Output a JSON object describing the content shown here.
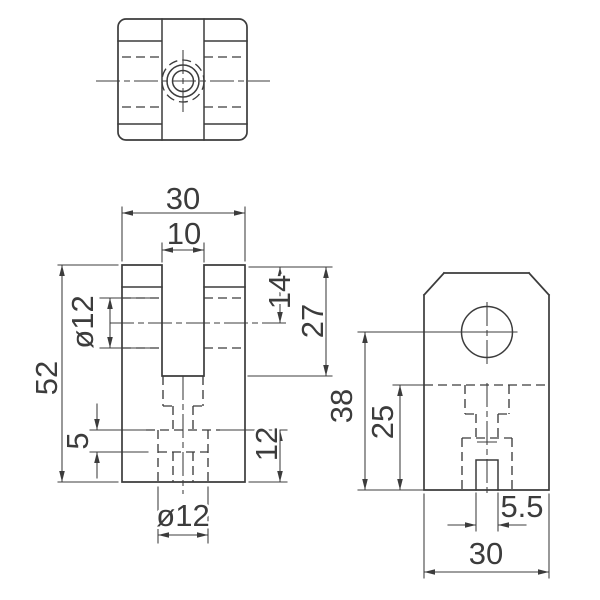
{
  "drawing": {
    "dimensions": {
      "front": {
        "overall_width": "30",
        "slot_width": "10",
        "overall_height": "52",
        "cross_hole_diameter": "ø12",
        "hole_axis_from_top": "14",
        "slot_depth": "27",
        "step_height": "5",
        "bottom_hole_depth": "12",
        "bottom_hole_diameter": "ø12"
      },
      "side": {
        "hole_axis_from_bottom": "38",
        "slot_floor_from_bottom": "25",
        "bottom_slot_width": "5.5",
        "overall_depth": "30"
      }
    }
  }
}
